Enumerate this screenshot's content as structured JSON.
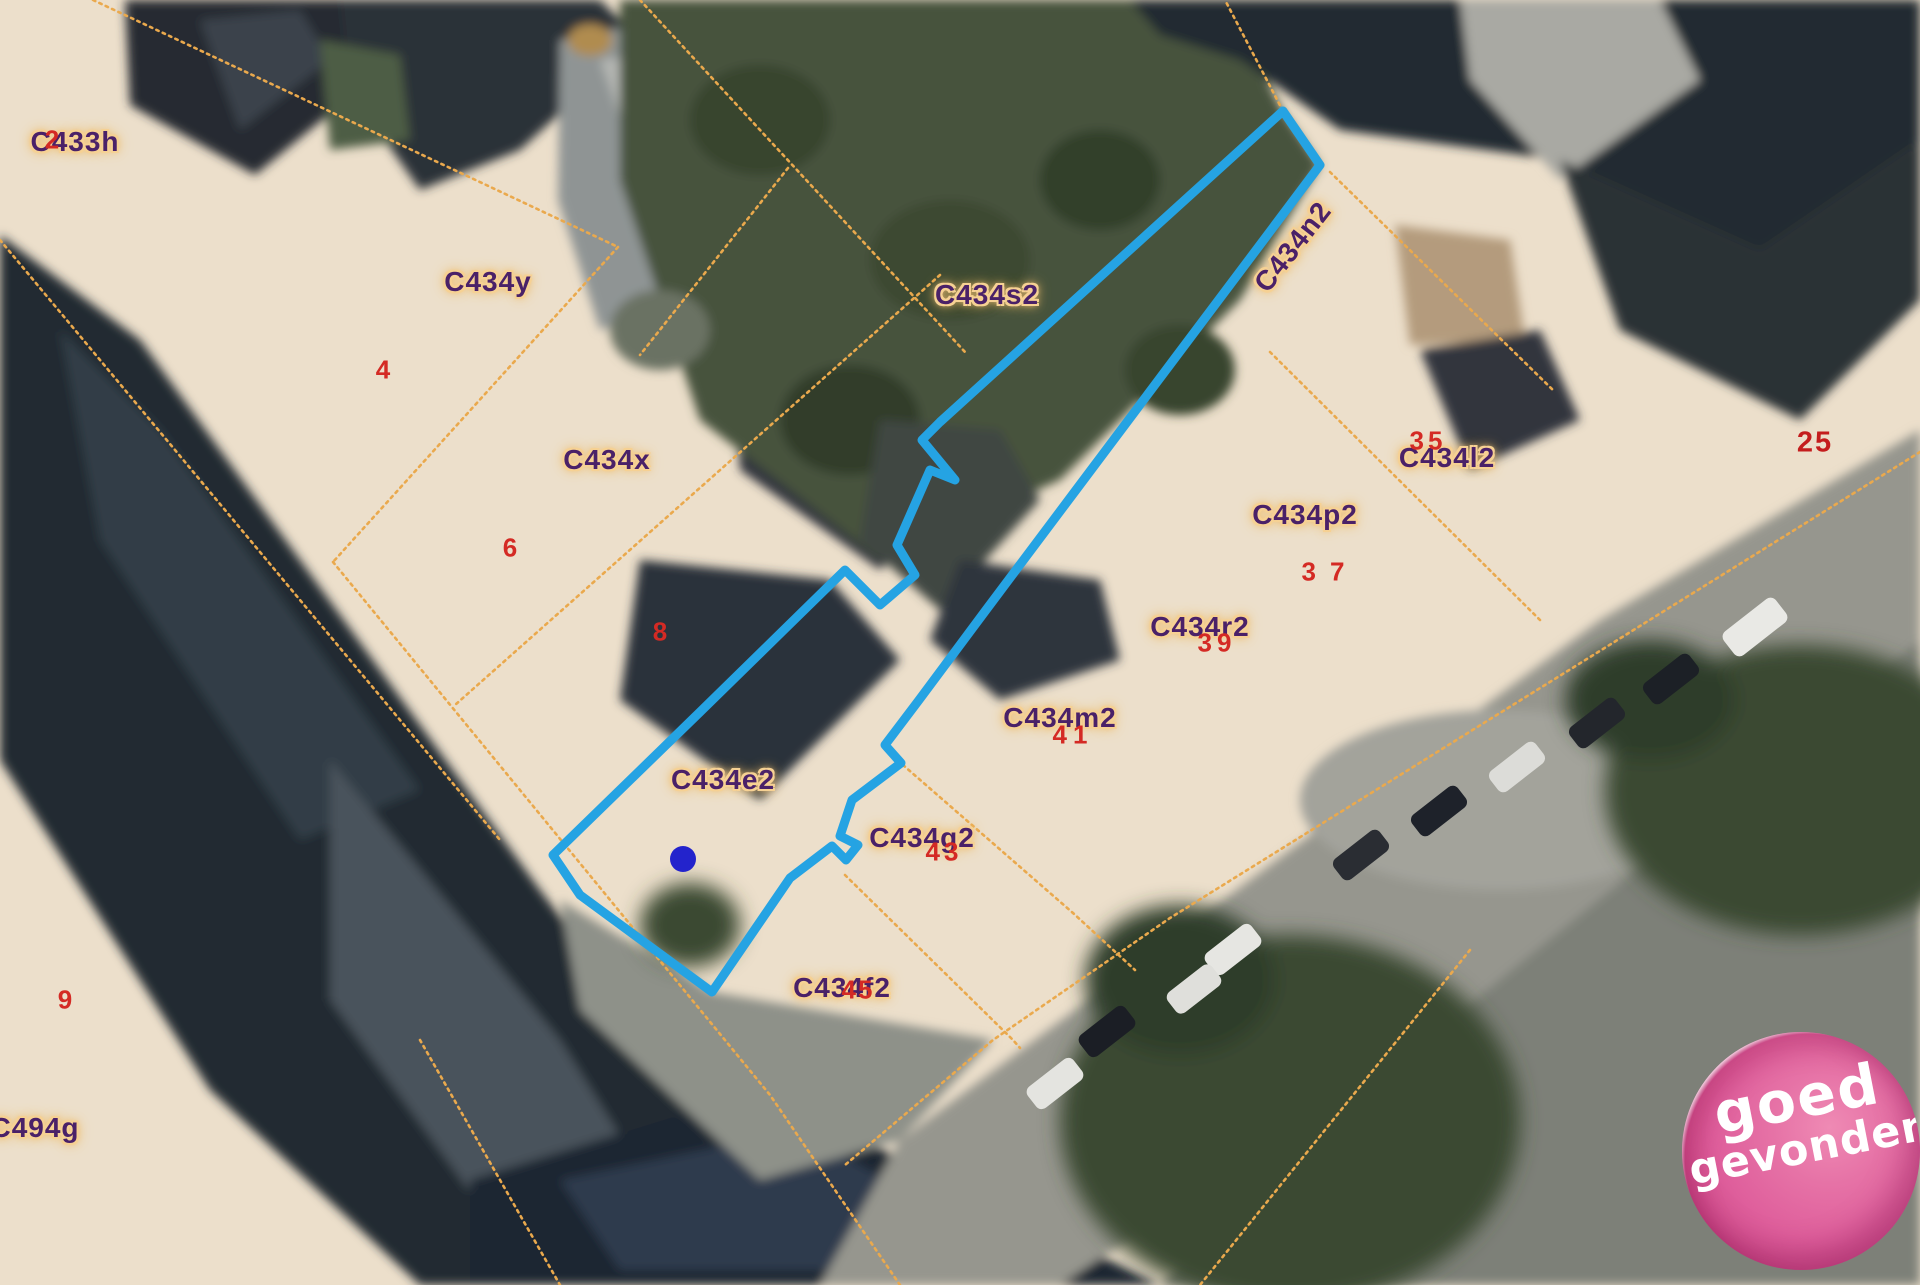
{
  "map": {
    "parcel_labels": [
      {
        "text": "C433h",
        "x": 75,
        "y": 142
      },
      {
        "text": "C434y",
        "x": 488,
        "y": 282
      },
      {
        "text": "C434s2",
        "x": 987,
        "y": 295
      },
      {
        "text": "C434n2",
        "x": 1293,
        "y": 247,
        "rotate": -52
      },
      {
        "text": "C434x",
        "x": 607,
        "y": 460
      },
      {
        "text": "C434l2",
        "x": 1447,
        "y": 458
      },
      {
        "text": "C434p2",
        "x": 1305,
        "y": 515
      },
      {
        "text": "C434r2",
        "x": 1200,
        "y": 627
      },
      {
        "text": "C434m2",
        "x": 1060,
        "y": 718
      },
      {
        "text": "C434e2",
        "x": 723,
        "y": 780
      },
      {
        "text": "C434g2",
        "x": 922,
        "y": 838
      },
      {
        "text": "C434f2",
        "x": 842,
        "y": 988
      },
      {
        "text": "C494g",
        "x": 35,
        "y": 1128
      }
    ],
    "house_numbers": [
      {
        "text": "2",
        "x": 52,
        "y": 140
      },
      {
        "text": "4",
        "x": 383,
        "y": 370
      },
      {
        "text": "6",
        "x": 510,
        "y": 548
      },
      {
        "text": "8",
        "x": 660,
        "y": 632
      },
      {
        "text": "9",
        "x": 65,
        "y": 1000
      },
      {
        "text": "25",
        "x": 1815,
        "y": 443,
        "big": true
      },
      {
        "text": "35",
        "x": 1428,
        "y": 441,
        "spacing": 4
      },
      {
        "text": "37",
        "x": 1330,
        "y": 572,
        "spacing": 14
      },
      {
        "text": "39",
        "x": 1217,
        "y": 643,
        "spacing": 5
      },
      {
        "text": "41",
        "x": 1073,
        "y": 735,
        "spacing": 6
      },
      {
        "text": "43",
        "x": 944,
        "y": 852,
        "spacing": 4
      },
      {
        "text": "45",
        "x": 858,
        "y": 990,
        "spacing": 2
      }
    ],
    "selected_parcel": {
      "outline": [
        [
          1283,
          111
        ],
        [
          1320,
          165
        ],
        [
          1175,
          358
        ],
        [
          1076,
          490
        ],
        [
          986,
          610
        ],
        [
          919,
          700
        ],
        [
          885,
          745
        ],
        [
          901,
          763
        ],
        [
          852,
          800
        ],
        [
          840,
          836
        ],
        [
          858,
          845
        ],
        [
          846,
          860
        ],
        [
          832,
          846
        ],
        [
          790,
          878
        ],
        [
          712,
          992
        ],
        [
          580,
          895
        ],
        [
          553,
          855
        ],
        [
          700,
          712
        ],
        [
          845,
          570
        ],
        [
          880,
          605
        ],
        [
          915,
          575
        ],
        [
          897,
          545
        ],
        [
          930,
          470
        ],
        [
          955,
          480
        ],
        [
          922,
          440
        ],
        [
          940,
          422
        ]
      ],
      "marker": {
        "x": 683,
        "y": 859,
        "radius": 13
      }
    },
    "boundary_lines": [
      [
        [
          93,
          0
        ],
        [
          618,
          247
        ]
      ],
      [
        [
          618,
          247
        ],
        [
          333,
          562
        ]
      ],
      [
        [
          333,
          562
        ],
        [
          770,
          1095
        ],
        [
          900,
          1285
        ]
      ],
      [
        [
          940,
          275
        ],
        [
          455,
          705
        ]
      ],
      [
        [
          640,
          0
        ],
        [
          965,
          352
        ]
      ],
      [
        [
          788,
          168
        ],
        [
          640,
          355
        ]
      ],
      [
        [
          1330,
          172
        ],
        [
          1555,
          392
        ]
      ],
      [
        [
          1270,
          352
        ],
        [
          1540,
          620
        ]
      ],
      [
        [
          1920,
          452
        ],
        [
          1170,
          918
        ],
        [
          993,
          1040
        ],
        [
          845,
          1165
        ]
      ],
      [
        [
          903,
          765
        ],
        [
          1073,
          913
        ],
        [
          1135,
          970
        ]
      ],
      [
        [
          845,
          875
        ],
        [
          1013,
          1040
        ],
        [
          1020,
          1048
        ]
      ],
      [
        [
          1470,
          950
        ],
        [
          1200,
          1285
        ]
      ],
      [
        [
          420,
          1040
        ],
        [
          560,
          1285
        ]
      ],
      [
        [
          1283,
          111
        ],
        [
          1225,
          0
        ]
      ],
      [
        [
          0,
          240
        ],
        [
          500,
          840
        ]
      ]
    ],
    "colors": {
      "selection_stroke": "#25a3e3",
      "marker_fill": "#2323cc",
      "boundary": "#eaa94d",
      "label": "#4a2168",
      "number": "#d42a24",
      "parcel_fill": "#ecdfcb"
    }
  },
  "logo": {
    "line1": "goed",
    "line2": "gevonden",
    "background": "#df5f9c"
  }
}
